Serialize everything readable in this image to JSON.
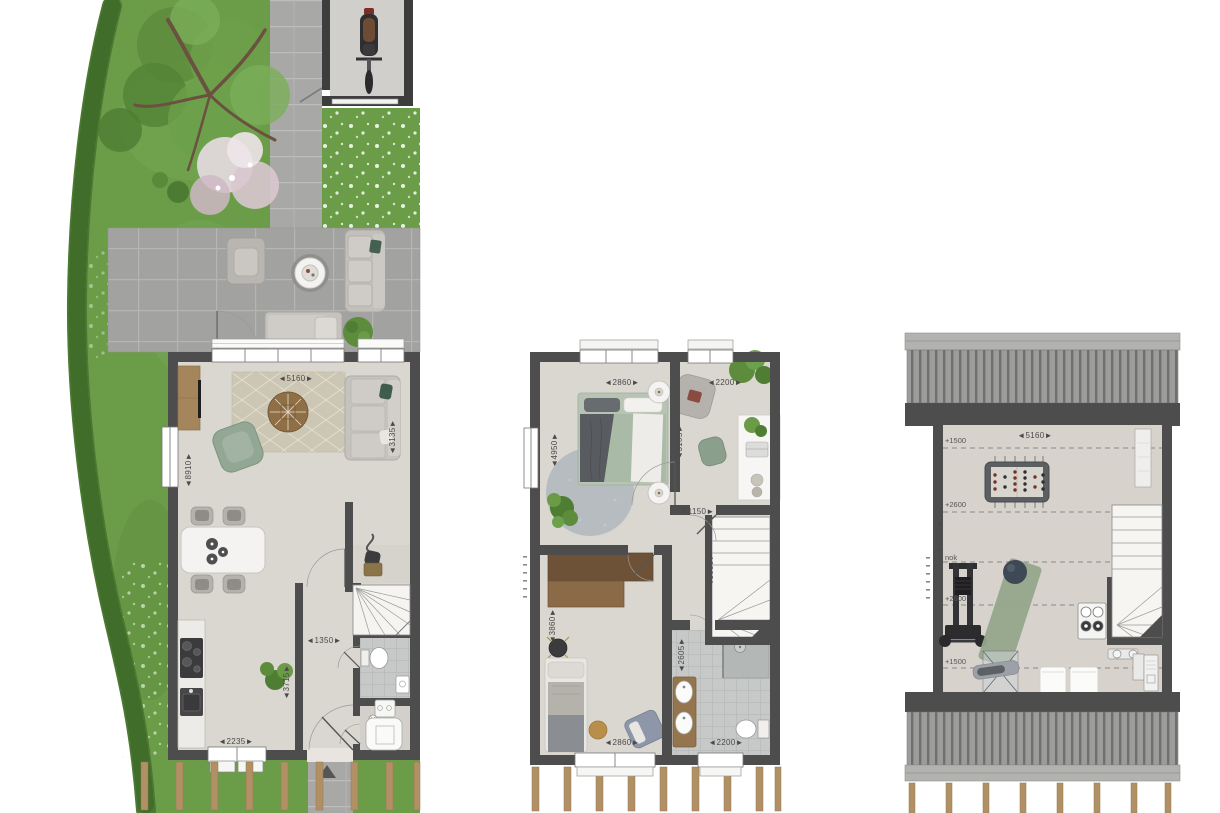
{
  "document": {
    "type": "architectural floor plans, top view, furnished, with garden"
  },
  "palette": {
    "wall": "#4d4d4d",
    "grass": "#6b9d49",
    "hedge": "#4c7a32",
    "paving": "#a2a2a0",
    "floor": "#dad6d0",
    "bath_tile": "#c6c9c8",
    "wood_posts": "#b29065",
    "accent_green": "#93a795"
  },
  "ground_floor": {
    "dim_width_top": "◄5160►",
    "dim_depth_left": "◄8910►",
    "dim_living_right": "◄3135►",
    "dim_hall_width": "◄1350►",
    "dim_hall_depth": "◄3715►",
    "dim_kitchen_window": "◄2235►"
  },
  "first_floor": {
    "dim_bedroom1_width": "◄2860►",
    "dim_office_width": "◄2200►",
    "dim_bedroom1_depth": "◄4950►",
    "dim_office_depth": "◄3105►",
    "dim_landing_width": "◄1150►",
    "dim_stair_depth": "◄3000►",
    "dim_bedroom2_depth": "◄3860►",
    "dim_bathroom_depth": "◄2605►",
    "dim_bedroom2_width": "◄2860►",
    "dim_bathroom_width": "◄2200►"
  },
  "attic": {
    "dim_width_top": "◄5160►",
    "dim_depth_left": "◄6205►",
    "height_upper": "+1500",
    "height_mid_upper": "+2600",
    "ridge_label": "nok",
    "height_mid_lower": "+2600",
    "height_lower": "+1500"
  }
}
